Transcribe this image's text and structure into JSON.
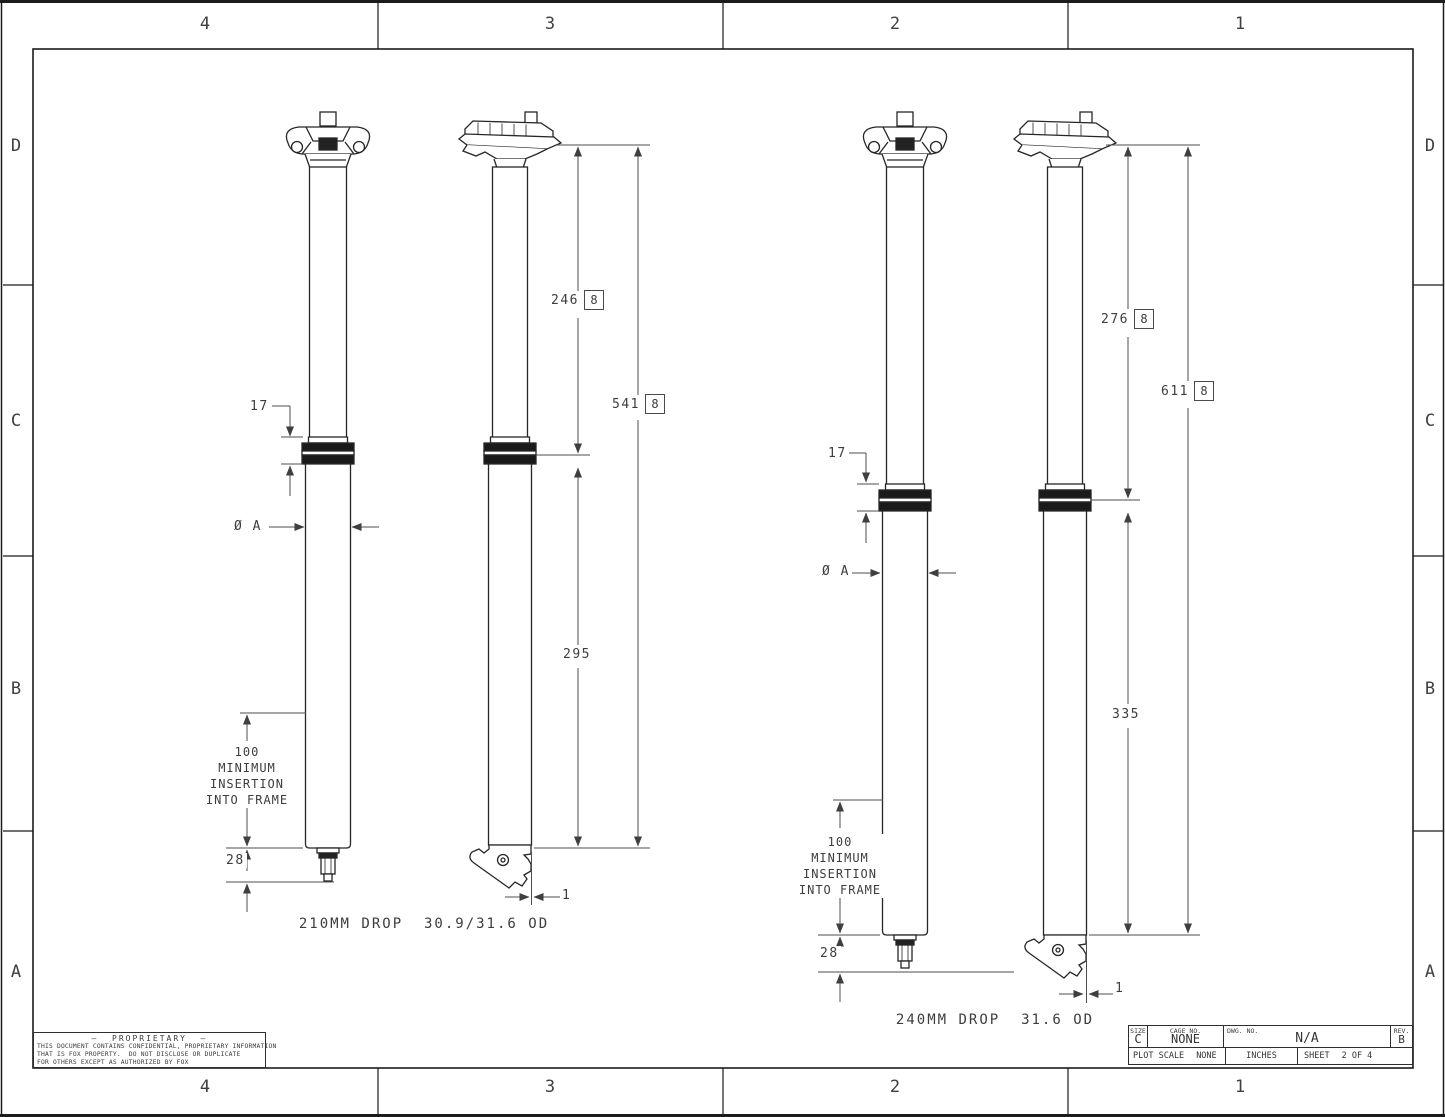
{
  "sheet": {
    "zones": {
      "columns": [
        "4",
        "3",
        "2",
        "1"
      ],
      "rows": [
        "D",
        "C",
        "B",
        "A"
      ]
    },
    "proprietary": {
      "title": "—  PROPRIETARY  —",
      "line1": "THIS DOCUMENT CONTAINS CONFIDENTIAL, PROPRIETARY INFORMATION",
      "line2": "THAT IS FOX PROPERTY.  DO NOT DISCLOSE OR DUPLICATE",
      "line3": "FOR OTHERS EXCEPT AS AUTHORIZED BY FOX"
    },
    "title_block": {
      "size_label": "SIZE",
      "size_value": "C",
      "cage_label": "CAGE NO.",
      "cage_value": "NONE",
      "dwg_label": "DWG. NO.",
      "dwg_value": "N/A",
      "rev_label": "REV.",
      "rev_value": "B",
      "plot_scale_label": "PLOT SCALE",
      "plot_scale_value": "NONE",
      "units_value": "INCHES",
      "sheet_label": "SHEET",
      "sheet_value": "2 OF 4"
    }
  },
  "views": {
    "left": {
      "caption": "210MM DROP  30.9/31.6 OD",
      "flag_note": "8",
      "dims": {
        "collar_height": "17",
        "diameter": "Ø A",
        "extended_length": "246",
        "overall_length": "541",
        "lower_length": "295",
        "actuator_depth": "28",
        "lever_offset": "1"
      },
      "insertion": [
        "100",
        "MINIMUM",
        "INSERTION",
        "INTO FRAME"
      ]
    },
    "right": {
      "caption": "240MM DROP  31.6 OD",
      "flag_note": "8",
      "dims": {
        "collar_height": "17",
        "diameter": "Ø A",
        "extended_length": "276",
        "overall_length": "611",
        "lower_length": "335",
        "actuator_depth": "28",
        "lever_offset": "1"
      },
      "insertion": [
        "100",
        "MINIMUM",
        "INSERTION",
        "INTO FRAME"
      ]
    }
  }
}
